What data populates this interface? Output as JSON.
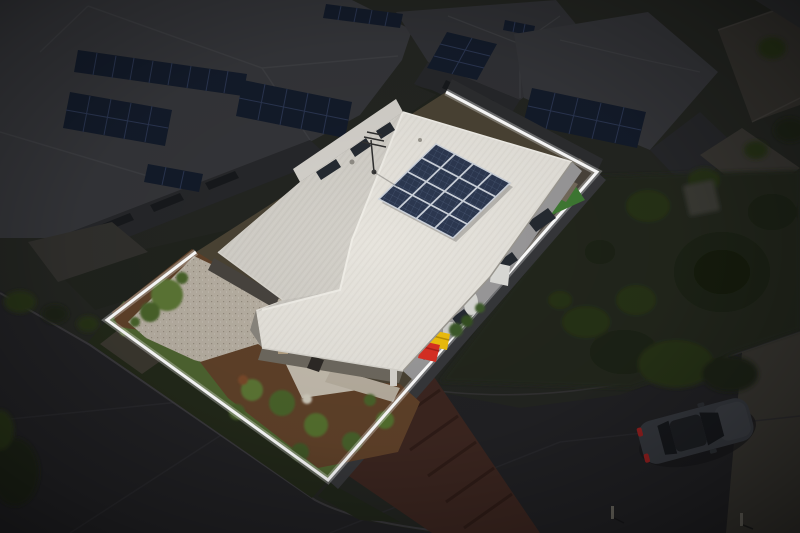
{
  "scene": {
    "type": "aerial-drone-photograph",
    "subject": "single-storey house with white corrugated metal roof and rooftop solar array",
    "highlight": "property lot outlined with a white boundary line, surrounding neighbourhood darkened",
    "time_of_day": "daytime",
    "environment": "suburban estate, neighbouring homes with rooftop solar panels",
    "vehicles": [
      "dark hatchback parked on street, lower right"
    ],
    "bins": [
      "red wheelie bin",
      "yellow wheelie bin"
    ]
  },
  "solar": {
    "main_array_rows": 4,
    "main_array_cols": 4,
    "main_array_panels": 16,
    "neighbour_arrays": 8
  },
  "colors": {
    "base_dark": "#232521",
    "asphalt": "#212124",
    "asphalt_light": "#2a2a2e",
    "footpath": "#383631",
    "kerb": "#3c3b3e",
    "nature_strip": "#222819",
    "dark_lawn": "#262c1c",
    "tree_dark": "#1b2312",
    "tree_mid": "#273218",
    "bush_lit": "#5c7635",
    "bush_lit_2": "#48642b",
    "lawn": "#4e6430",
    "turf": "#3f7a33",
    "mulch": "#5f4129",
    "soil_base": "#4a4334",
    "paver_strip": "#3c2620",
    "driveway": "#b7afa2",
    "paving": "#c3bbad",
    "paving_2": "#b7ae9f",
    "roof_main": "#e6e3dc",
    "roof_shade": "#d2cfc8",
    "roof_porch": "#c9c6bf",
    "ridge_cap": "#f0eee8",
    "fascia": "#9c9992",
    "clerestory_wall": "#d4d1cb",
    "wall_se": "#9a999a",
    "wall_front": "#6e695f",
    "garage_door": "#48443f",
    "window": "#252a31",
    "solar_panel": "#2c3850",
    "solar_grid": "#ccd2db",
    "solar_dark": "#131b2a",
    "solar_dark_grid": "#2a3550",
    "neighbor_roof": "#343539",
    "neighbor_roof_2": "#303135",
    "neighbor_ridge": "#3f4044",
    "neighbor_wall": "#26272a",
    "fence": "#36373a",
    "yard_dark": "#20231d",
    "boundary": "#ffffff",
    "bin_red": "#d92f23",
    "bin_yellow": "#eebe0c",
    "white_goods": "#dcdcd8",
    "pergola": "#746a5c",
    "car_body": "#35383e",
    "car_glass": "#16181c",
    "car_roof": "#1d1f23",
    "tail_light": "#962020",
    "post": "#6a675f",
    "antenna": "#2f2f2f"
  }
}
